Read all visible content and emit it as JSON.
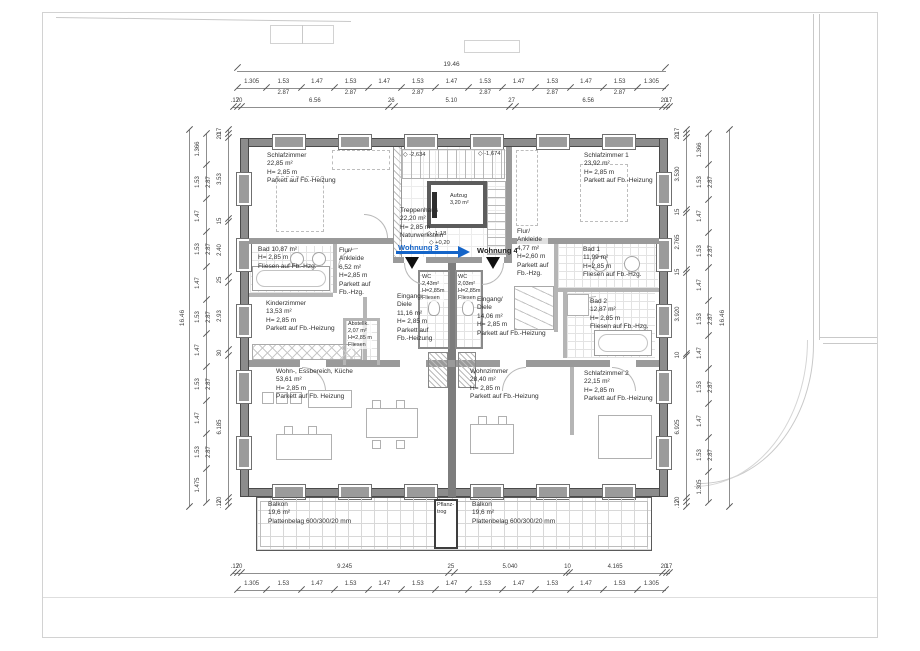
{
  "apartments": {
    "left": "Wohnung 3",
    "right": "Wohnung 4"
  },
  "levels": {
    "stair_upper_left": "-2,634",
    "stair_upper_right": "-1,674",
    "landing_a": "-1,18",
    "landing_b": "+0,20",
    "mark_symbol": "◇"
  },
  "rooms": {
    "schlafzimmer": {
      "lines": [
        "Schlafzimmer",
        "22,85 m²",
        "H= 2,85 m",
        "Parkett auf Fb.-Heizung"
      ]
    },
    "bad": {
      "lines": [
        "Bad 10,87 m²",
        "H= 2,85 m",
        "Fliesen auf Fb.-Hzg."
      ]
    },
    "flur_ankleide_l": {
      "lines": [
        "Flur/",
        "Ankleide",
        "6,52 m²",
        "H=2,85 m",
        "Parkett auf",
        "Fb.-Hzg."
      ]
    },
    "kinderzimmer": {
      "lines": [
        "Kinderzimmer",
        "13,53 m²",
        "H= 2,85 m",
        "Parkett auf Fb.-Heizung"
      ]
    },
    "abstellkammer": {
      "lines": [
        "Abstellk.",
        "2,07 m²",
        "H=2,85 m",
        "Fliesen"
      ]
    },
    "eingang_diele_l": {
      "lines": [
        "Eingang/",
        "Diele",
        "11,16 m²",
        "H= 2,85 m",
        "Parkett auf",
        "Fb.-Heizung"
      ]
    },
    "wc_l": {
      "lines": [
        "WC",
        "2,43m²",
        "H=2,85m",
        "Fliesen"
      ]
    },
    "wohn_essbereich": {
      "lines": [
        "Wohn-, Essbereich, Küche",
        "53,61 m²",
        "H= 2,85 m",
        "Parkett auf Fb. Heizung"
      ]
    },
    "treppenhaus": {
      "lines": [
        "Treppenhaus",
        "22,20 m²",
        "H= 2,85 m",
        "Naturwerkstein"
      ]
    },
    "aufzug": {
      "lines": [
        "Aufzug",
        "3,20 m²"
      ]
    },
    "schlafzimmer1": {
      "lines": [
        "Schlafzimmer 1",
        "23,92 m²",
        "H= 2,85 m",
        "Parkett auf Fb.-Heizung"
      ]
    },
    "flur_ankleide_r": {
      "lines": [
        "Flur/",
        "Ankleide",
        "4,77 m²",
        "H=2,60 m",
        "Parkett auf",
        "Fb.-Hzg."
      ]
    },
    "bad1": {
      "lines": [
        "Bad 1",
        "11,99 m²",
        "H=2,85 m",
        "Fliesen auf Fb.-Hzg."
      ]
    },
    "wc_r": {
      "lines": [
        "WC",
        "2,03m²",
        "H=2,85m",
        "Fliesen"
      ]
    },
    "eingang_diele_r": {
      "lines": [
        "Eingang/",
        "Diele",
        "14,06 m²",
        "H= 2,85 m",
        "Parkett auf Fb.-Heizung"
      ]
    },
    "bad2": {
      "lines": [
        "Bad 2",
        "12,87 m²",
        "H= 2,85 m",
        "Fliesen auf Fb.-Hzg."
      ]
    },
    "schlafzimmer2": {
      "lines": [
        "Schlafzimmer 2",
        "22,15 m²",
        "H= 2,85 m",
        "Parkett auf Fb.-Heizung"
      ]
    },
    "wohnzimmer": {
      "lines": [
        "Wohnzimmer",
        "28,40 m²",
        "H= 2,85 m",
        "Parkett auf Fb.-Heizung"
      ]
    },
    "balkon_l": {
      "lines": [
        "Balkon",
        "19,6 m²",
        "Plattenbelag 600/300/20 mm"
      ]
    },
    "balkon_r": {
      "lines": [
        "Balkon",
        "19,6 m²",
        "Plattenbelag 600/300/20 mm"
      ]
    },
    "pflanztrog": {
      "lines": [
        "Pflanz-",
        "trog"
      ]
    }
  },
  "dims": {
    "top_total": "19.46",
    "left_total": "16.46",
    "right_total": "16.46",
    "top_chain": [
      {
        "t": "1.305"
      },
      {
        "t": "1.53",
        "b": "2.87"
      },
      {
        "t": "1.47"
      },
      {
        "t": "1.53",
        "b": "2.87"
      },
      {
        "t": "1.47"
      },
      {
        "t": "1.53",
        "b": "2.87"
      },
      {
        "t": "1.47"
      },
      {
        "t": "1.53",
        "b": "2.87"
      },
      {
        "t": "1.47"
      },
      {
        "t": "1.53",
        "b": "2.87"
      },
      {
        "t": "1.47"
      },
      {
        "t": "1.53",
        "b": "2.87"
      },
      {
        "t": "1.305"
      }
    ],
    "top_inner": [
      {
        "t": ".17",
        "w": 0.17
      },
      {
        "t": "20",
        "w": 0.2
      },
      {
        "t": "6.56",
        "w": 6.56
      },
      {
        "t": "26",
        "w": 0.26
      },
      {
        "t": "5.10",
        "w": 5.1
      },
      {
        "t": "27",
        "w": 0.27
      },
      {
        "t": "6.56",
        "w": 6.56
      },
      {
        "t": "20",
        "w": 0.2
      },
      {
        "t": ".17",
        "w": 0.17
      }
    ],
    "bottom_inner": [
      {
        "t": ".17",
        "w": 0.17
      },
      {
        "t": "20",
        "w": 0.2
      },
      {
        "t": "9.245",
        "w": 9.245
      },
      {
        "t": "25",
        "w": 0.25
      },
      {
        "t": "5.040",
        "w": 5.04
      },
      {
        "t": "10",
        "w": 0.1
      },
      {
        "t": "4.165",
        "w": 4.165
      },
      {
        "t": "20",
        "w": 0.2
      },
      {
        "t": ".17",
        "w": 0.17
      }
    ],
    "bottom_chain": [
      {
        "t": "1.305"
      },
      {
        "t": "1.53"
      },
      {
        "t": "1.47"
      },
      {
        "t": "1.53"
      },
      {
        "t": "1.47"
      },
      {
        "t": "1.53"
      },
      {
        "t": "1.47"
      },
      {
        "t": "1.53"
      },
      {
        "t": "1.47"
      },
      {
        "t": "1.53"
      },
      {
        "t": "1.47"
      },
      {
        "t": "1.53"
      },
      {
        "t": "1.305"
      }
    ],
    "left_chain": [
      {
        "t": "1.366"
      },
      {
        "t": "1.53",
        "b": "2.87"
      },
      {
        "t": "1.47"
      },
      {
        "t": "1.53",
        "b": "2.87"
      },
      {
        "t": "1.47"
      },
      {
        "t": "1.53",
        "b": "2.87"
      },
      {
        "t": "1.47"
      },
      {
        "t": "1.53",
        "b": "2.87"
      },
      {
        "t": "1.47"
      },
      {
        "t": "1.53",
        "b": "2.87"
      },
      {
        "t": "1.475"
      }
    ],
    "left_inner": [
      {
        "t": ".17",
        "w": 0.17
      },
      {
        "t": "20",
        "w": 0.2
      },
      {
        "t": "3.53",
        "w": 3.53
      },
      {
        "t": "15",
        "w": 0.15
      },
      {
        "t": "2.40",
        "w": 2.4
      },
      {
        "t": "25",
        "w": 0.25
      },
      {
        "t": "2.93",
        "w": 2.93
      },
      {
        "t": "30",
        "w": 0.3
      },
      {
        "t": "6.185",
        "w": 6.185
      },
      {
        "t": "20",
        "w": 0.2
      },
      {
        "t": ".17",
        "w": 0.17
      }
    ],
    "right_inner": [
      {
        "t": ".17",
        "w": 0.17
      },
      {
        "t": "20",
        "w": 0.2
      },
      {
        "t": "3.530",
        "w": 3.53
      },
      {
        "t": "15",
        "w": 0.15
      },
      {
        "t": "2.765",
        "w": 2.765
      },
      {
        "t": "15",
        "w": 0.15
      },
      {
        "t": "3.920",
        "w": 3.92
      },
      {
        "t": "10",
        "w": 0.1
      },
      {
        "t": "6.925",
        "w": 6.925
      },
      {
        "t": "20",
        "w": 0.2
      },
      {
        "t": ".17",
        "w": 0.17
      }
    ],
    "right_chain": [
      {
        "t": "1.366"
      },
      {
        "t": "1.53",
        "b": "2.87"
      },
      {
        "t": "1.47"
      },
      {
        "t": "1.53",
        "b": "2.87"
      },
      {
        "t": "1.47"
      },
      {
        "t": "1.53",
        "b": "2.87"
      },
      {
        "t": "1.47"
      },
      {
        "t": "1.53",
        "b": "2.87"
      },
      {
        "t": "1.47"
      },
      {
        "t": "1.53",
        "b": "2.87"
      },
      {
        "t": "1.305"
      }
    ]
  },
  "colors": {
    "accent_blue": "#1464c8",
    "wall_gray": "#8c8c8c"
  }
}
